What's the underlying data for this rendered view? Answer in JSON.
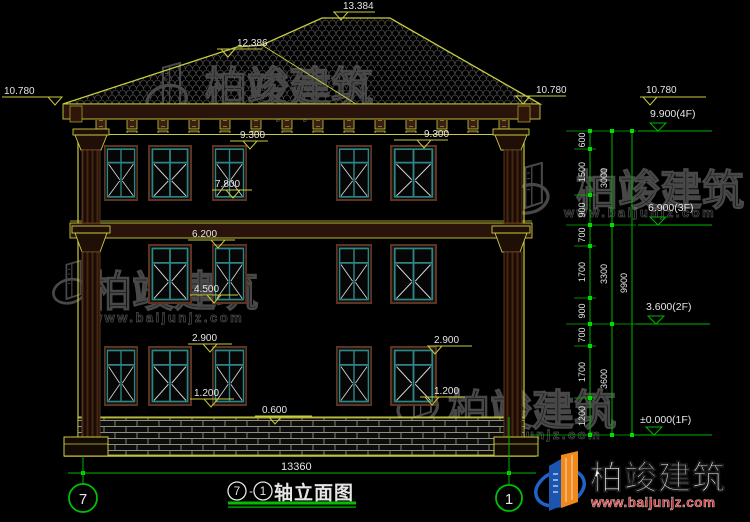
{
  "title_block": {
    "axis_from": "7",
    "separator": "-",
    "axis_to": "1",
    "name": "轴立面图"
  },
  "axis_bubbles": {
    "left": "7",
    "right": "1"
  },
  "elevation_marks": {
    "ridge_main": "13.384",
    "ridge_secondary": "12.386",
    "eave_left": "10.780",
    "eave_right": "10.780",
    "eave_level_note": "10.780",
    "window_head_3f_left": "9.300",
    "window_head_3f_right": "9.300",
    "window_sill_3f": "7.800",
    "band_2f": "6.200",
    "window_sill_2f": "4.500",
    "window_head_1f_left": "2.900",
    "window_head_1f_right": "2.900",
    "window_sill_1f_left": "1.200",
    "window_sill_1f_right": "1.200",
    "plinth_top": "0.600"
  },
  "floor_levels": [
    {
      "label": "9.900(4F)"
    },
    {
      "label": "6.900(3F)"
    },
    {
      "label": "3.600(2F)"
    },
    {
      "label": "±0.000(1F)"
    }
  ],
  "dimensions": {
    "overall_width": "13360",
    "total_height": "9900",
    "floor_heights": [
      "3000",
      "3300",
      "3600"
    ],
    "segments": [
      "600",
      "1500",
      "900",
      "700",
      "1700",
      "900",
      "700",
      "1700",
      "1200"
    ]
  },
  "watermark": {
    "company": "柏竣建筑",
    "website": "www.baijunjz.com"
  },
  "logo": {
    "company": "柏竣建筑",
    "website": "www.baijunjz.com"
  }
}
